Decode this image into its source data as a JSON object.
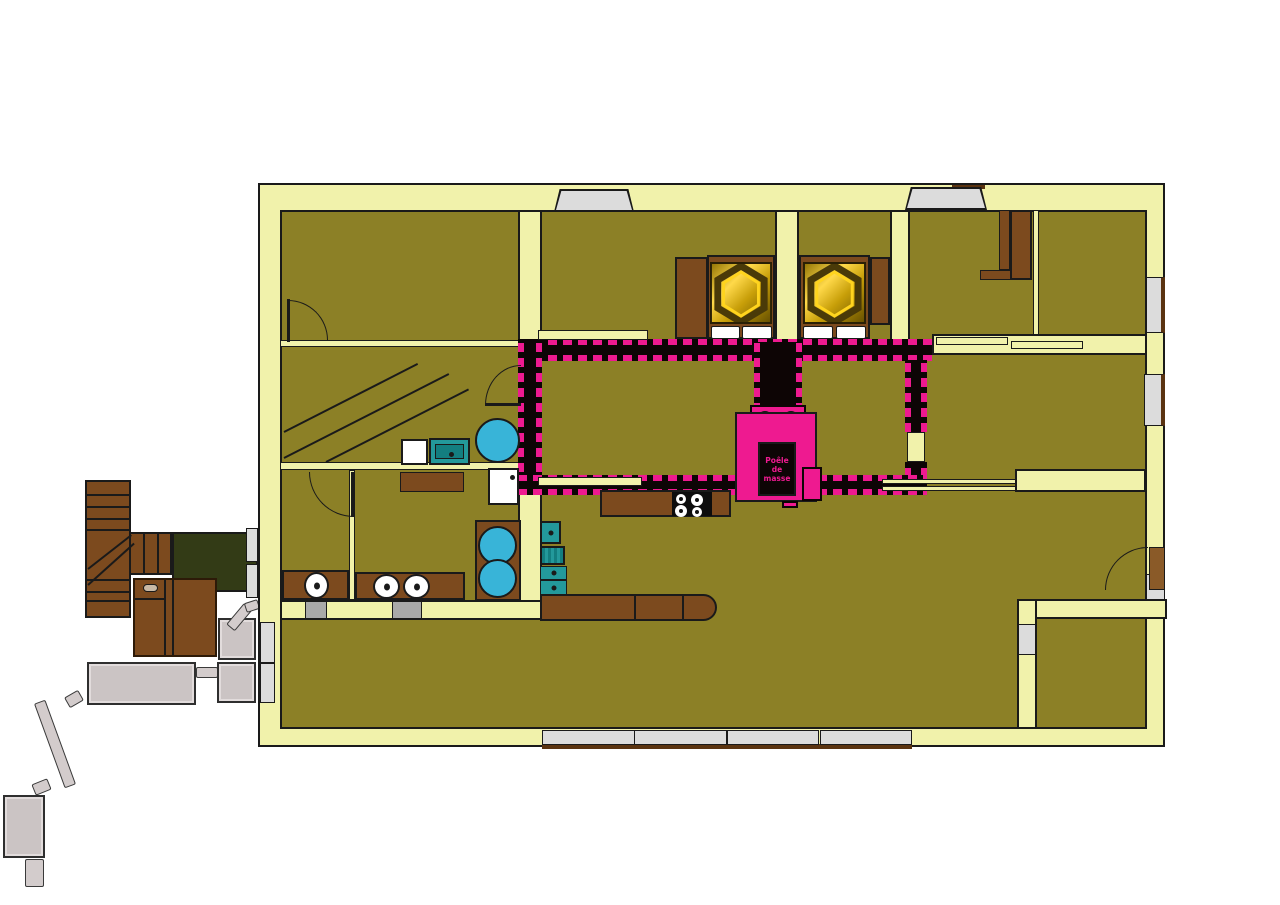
{
  "document": {
    "kind": "architectural floor plan with masonry heater ducting",
    "language": "French",
    "background": "#ffffff"
  },
  "stove": {
    "label": [
      "Poêle",
      "de",
      "masse"
    ]
  },
  "palette": {
    "wall": "#f1f2ab",
    "line": "#1a1a1a",
    "floor": "#8c8026",
    "pink": "#ee1a90",
    "core": "#0d0505",
    "brown": "#7c4a1e",
    "browndark": "#5a3310",
    "doorbrown": "#8a5a28",
    "blue": "#38b4d8",
    "teal": "#23999b",
    "tealdark": "#137e80",
    "gray": "#dcdcdc",
    "pipegray": "#cbc4c4",
    "green": "#333b16",
    "gold": "#f2c300",
    "white": "#ffffff"
  },
  "elements": [
    "masonry-heater",
    "heated-air-duct-walls",
    "double-bed",
    "double-bed",
    "kitchen-counter",
    "cooktop",
    "kitchen-island",
    "bathtub",
    "shower",
    "washing-machine",
    "washbasins",
    "wardrobe",
    "interior-stairs",
    "exterior-stairs",
    "exterior-landing",
    "wood-cabinet",
    "boiler-unit",
    "flue-pipe"
  ]
}
